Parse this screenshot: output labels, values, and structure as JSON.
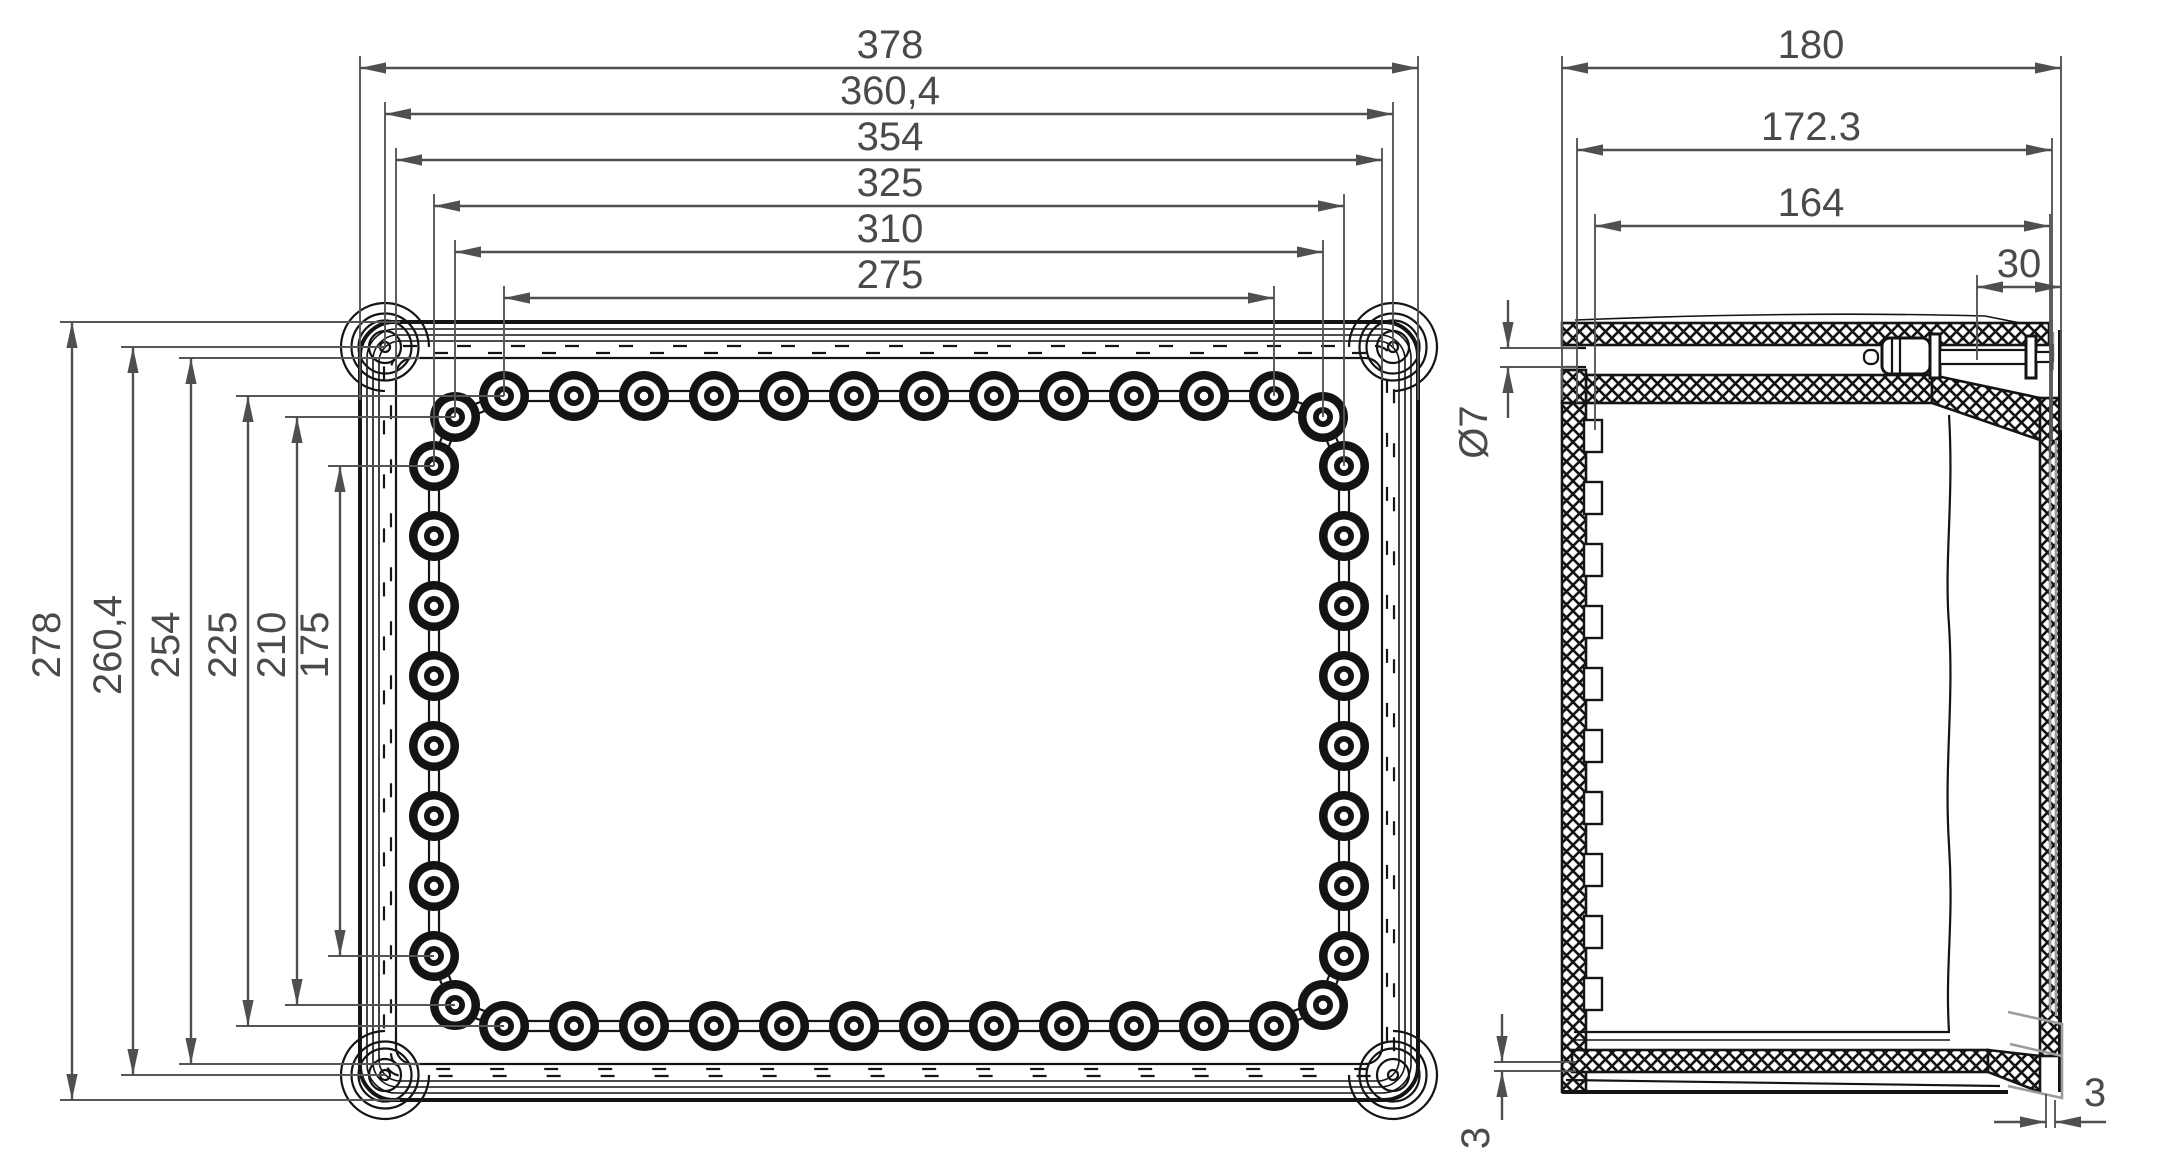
{
  "colors": {
    "line": "#141414",
    "dimension": "#4f4f4f",
    "lid_skirt": "#9c9c9c",
    "background": "#ffffff"
  },
  "plan_view": {
    "dims_horizontal": [
      {
        "label": "378"
      },
      {
        "label": "360,4"
      },
      {
        "label": "354"
      },
      {
        "label": "325"
      },
      {
        "label": "310"
      },
      {
        "label": "275"
      }
    ],
    "dims_vertical": [
      {
        "label": "278"
      },
      {
        "label": "260,4"
      },
      {
        "label": "254"
      },
      {
        "label": "225"
      },
      {
        "label": "210"
      },
      {
        "label": "175"
      }
    ]
  },
  "side_view": {
    "dims_horizontal": [
      {
        "label": "180"
      },
      {
        "label": "172.3"
      },
      {
        "label": "164"
      },
      {
        "label": "30"
      }
    ],
    "hole_diameter": {
      "label": "Ø7"
    },
    "base_thickness_left": {
      "label": "3"
    },
    "wall_gap_right": {
      "label": "3"
    }
  }
}
